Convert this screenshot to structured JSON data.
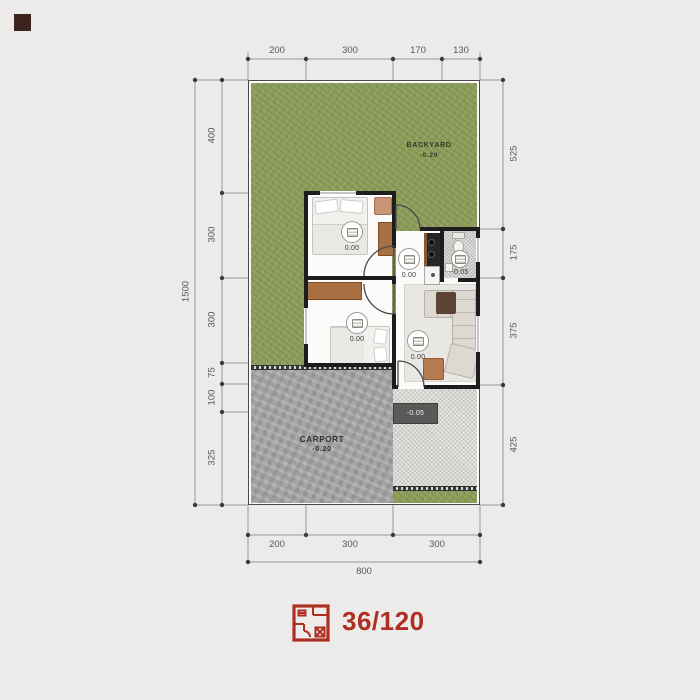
{
  "plan": {
    "backyard": {
      "label": "BACKYARD",
      "level": "-0.20"
    },
    "carport": {
      "label": "CARPORT",
      "level": "-0.20"
    },
    "terrace": {
      "level": "-0.05"
    },
    "markers": {
      "bedroom1": {
        "level": "0.00"
      },
      "bedroom2": {
        "level": "0.00"
      },
      "hallway": {
        "level": "0.00"
      },
      "bathroom": {
        "level": "-0.05"
      },
      "living": {
        "level": "0.00"
      }
    }
  },
  "dimensions": {
    "top": [
      "200",
      "300",
      "170",
      "130"
    ],
    "bottom": [
      "200",
      "300",
      "300"
    ],
    "bottom_total": "800",
    "left_total": "1500",
    "left": [
      "400",
      "300",
      "300",
      "75",
      "100",
      "325"
    ],
    "right": [
      "525",
      "175",
      "375",
      "425"
    ]
  },
  "footer": {
    "house_type": "36/120"
  },
  "colors": {
    "accent_red": "#ae2f22",
    "grass_green": "#8e9e5e",
    "carport_stone": "#a7a6a4",
    "wall_black": "#1d1d1d",
    "corner_square": "#3b241d"
  }
}
